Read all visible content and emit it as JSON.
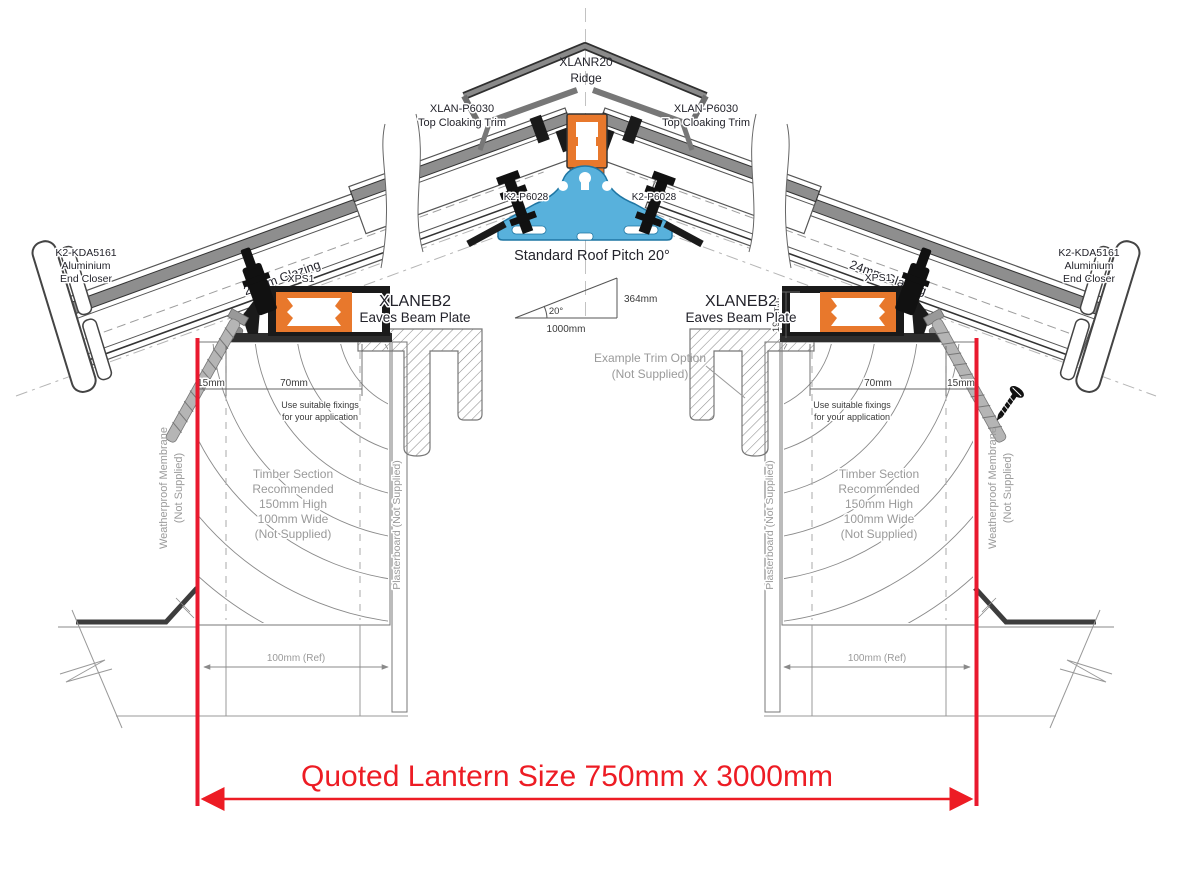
{
  "title": "Roof lantern eaves and ridge cross-section drawing",
  "labels": {
    "ridge": {
      "code": "XLANR20",
      "name": "Ridge"
    },
    "top_cloaking_trim": {
      "code": "XLAN-P6030",
      "name": "Top Cloaking Trim"
    },
    "ridge_bolt_code": "K2-P6028",
    "pitch": {
      "title": "Standard Roof Pitch 20°",
      "angle": "20°",
      "rise": "364mm",
      "run": "1000mm"
    },
    "end_closer": {
      "code": "K2-KDA5161",
      "line2": "Aluminium",
      "line3": "End Closer"
    },
    "glazing": "24mm Glazing",
    "xps": "XPS1",
    "eaves_beam": {
      "code": "XLANEB2",
      "name": "Eaves Beam Plate"
    },
    "dims": {
      "edge": "15mm",
      "fixing_zone": "70mm",
      "beam_height": "19.5mm",
      "kerb_ref": "100mm (Ref)"
    },
    "fixings_note": {
      "line1": "Use suitable fixings",
      "line2": "for your application"
    },
    "timber_note": {
      "line1": "Timber Section",
      "line2": "Recommended",
      "line3": "150mm High",
      "line4": "100mm Wide",
      "line5": "(Not Supplied)"
    },
    "membrane": {
      "line1": "Weatherproof Membrane",
      "line2": "(Not Supplied)"
    },
    "plasterboard": "Plasterboard (Not Supplied)",
    "trim_option": {
      "line1": "Example  Trim Option",
      "line2": "(Not Supplied)"
    },
    "quoted_size": "Quoted Lantern Size 750mm x 3000mm"
  },
  "colors": {
    "accent_red": "#ED1C24",
    "thermal_break_orange": "#E8782C",
    "ridge_beam_blue": "#58B1DC",
    "line_gray": "#555555",
    "muted_text": "#9A9A9A",
    "label_text": "#23232B"
  }
}
